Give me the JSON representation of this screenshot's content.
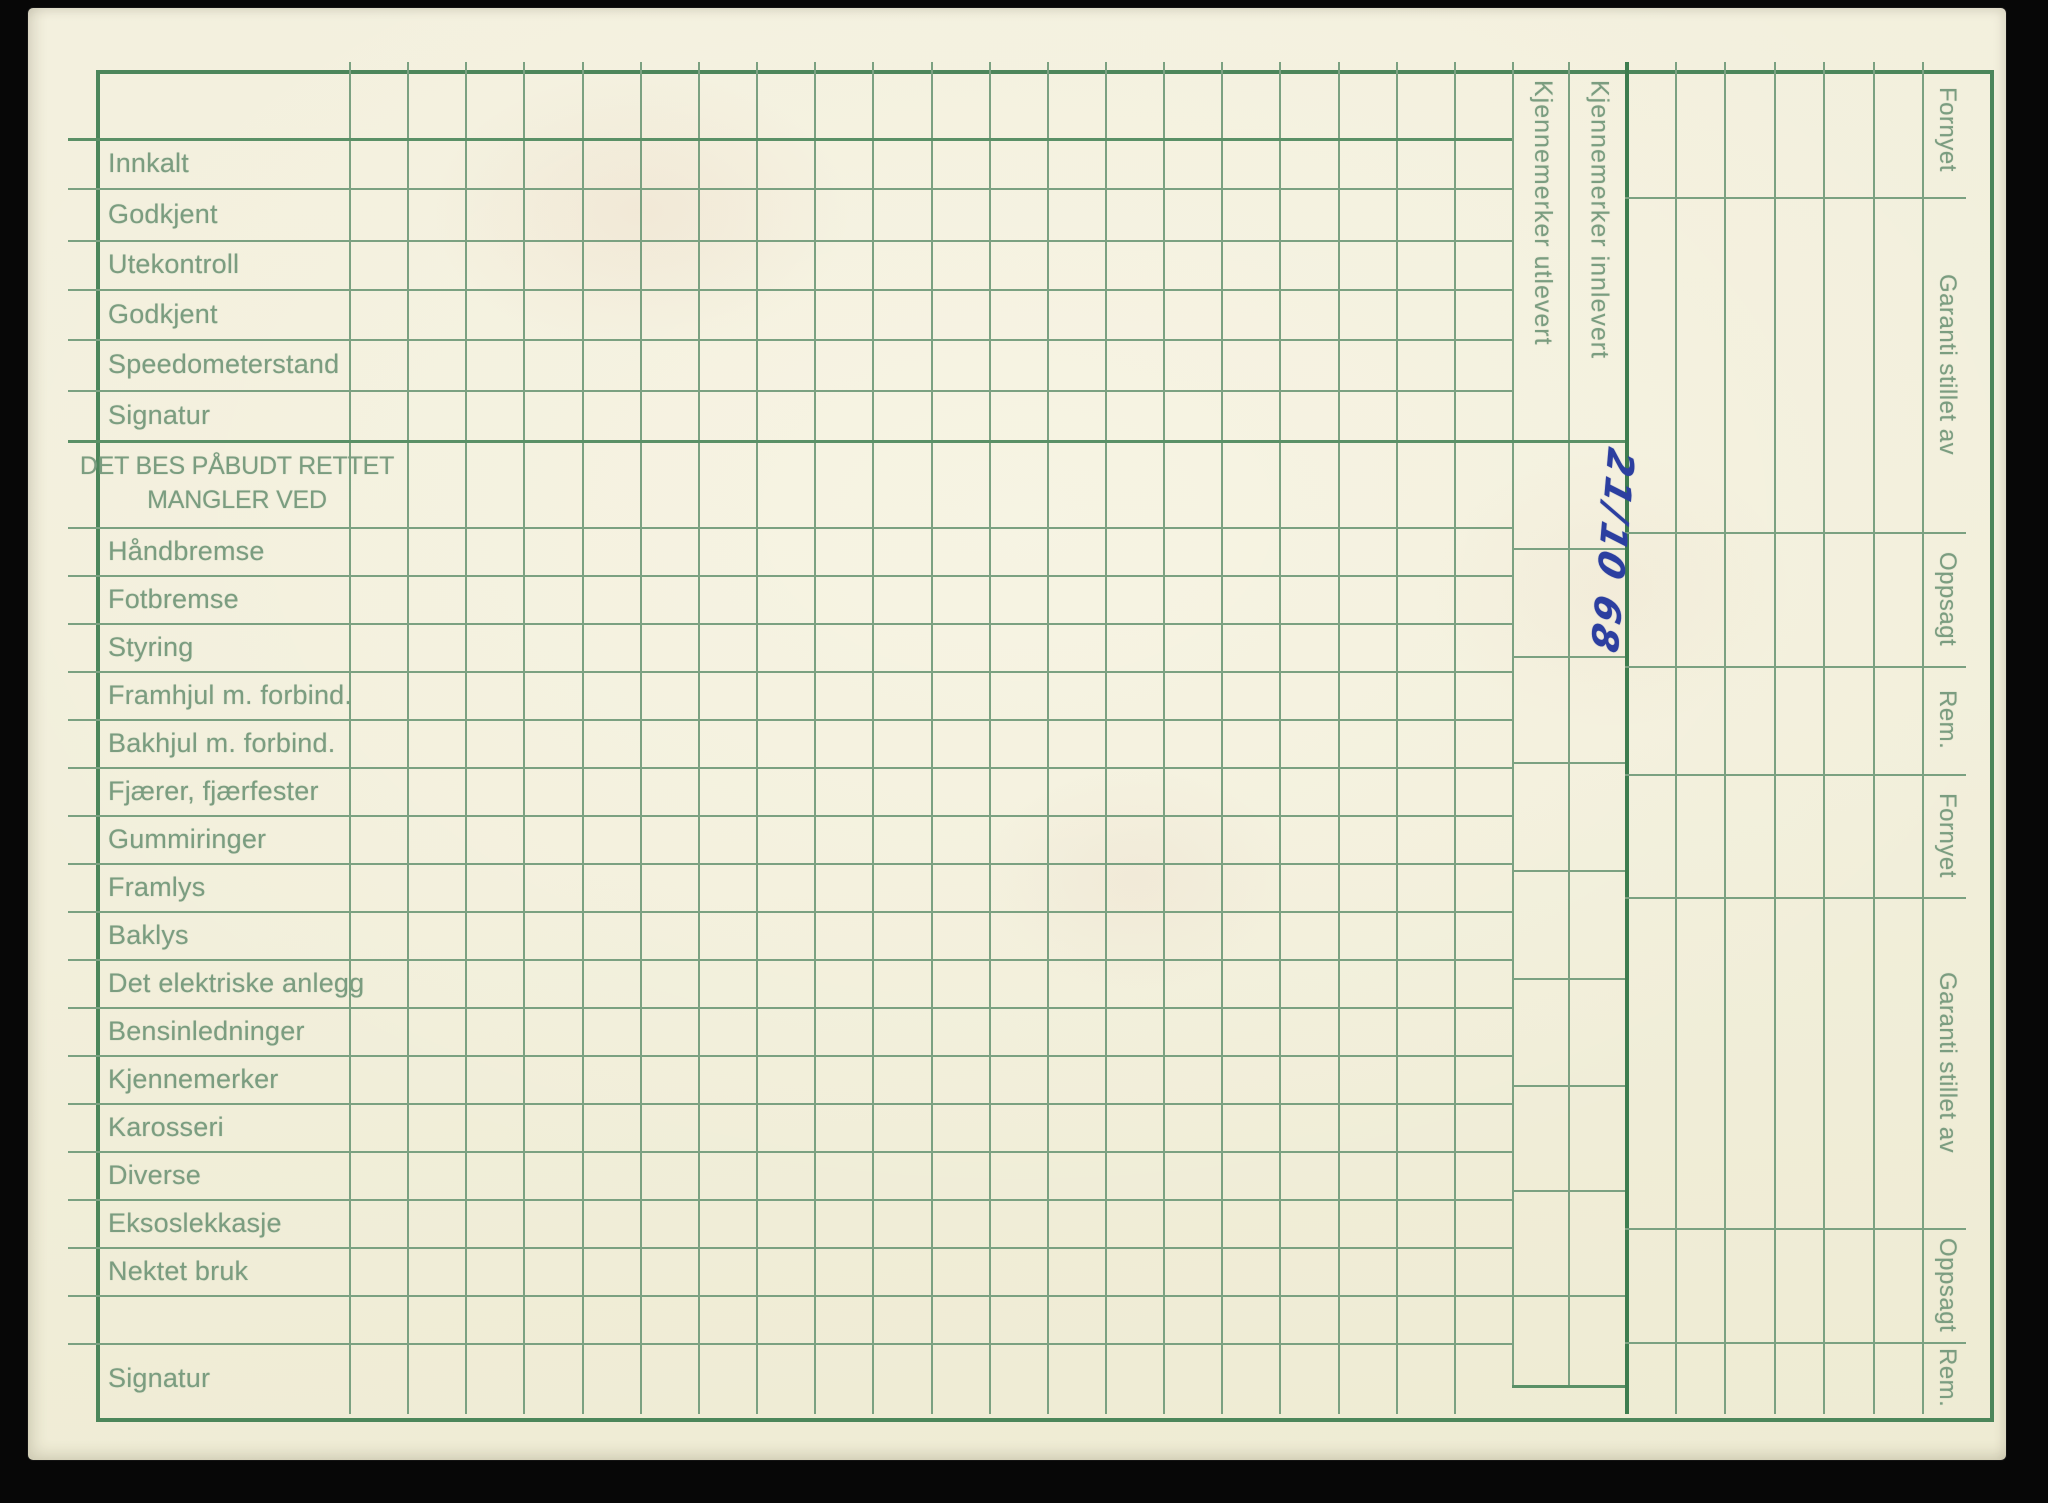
{
  "card": {
    "rows": {
      "status": [
        "Innkalt",
        "Godkjent",
        "Utekontroll",
        "Godkjent",
        "Speedometerstand",
        "Signatur"
      ],
      "section_header": {
        "line1": "DET BES PÅBUDT RETTET",
        "line2": "MANGLER VED"
      },
      "defects": [
        "Håndbremse",
        "Fotbremse",
        "Styring",
        "Framhjul m. forbind.",
        "Bakhjul m. forbind.",
        "Fjærer, fjærfester",
        "Gummiringer",
        "Framlys",
        "Baklys",
        "Det elektriske anlegg",
        "Bensinledninger",
        "Kjennemerker",
        "Karosseri",
        "Diverse",
        "Eksoslekkasje",
        "Nektet bruk"
      ],
      "footer": [
        "",
        "Signatur"
      ]
    },
    "plate_columns": [
      "Kjennemerker utlevert",
      "Kjennemerker innlevert"
    ],
    "right_labels": [
      "Fornyet",
      "Garanti stillet av",
      "Oppsagt",
      "Rem.",
      "Fornyet",
      "Garanti stillet av",
      "Oppsagt",
      "Rem."
    ],
    "handwriting": {
      "text": "21/10 68"
    },
    "colors": {
      "background": "#070707",
      "paper": "#f2efdc",
      "line_thin": "#7ba181",
      "line_mid": "#5a9066",
      "line_strong": "#3e7d4f",
      "label_text": "#7b9d80",
      "ink_blue": "#2c3fa0"
    }
  }
}
